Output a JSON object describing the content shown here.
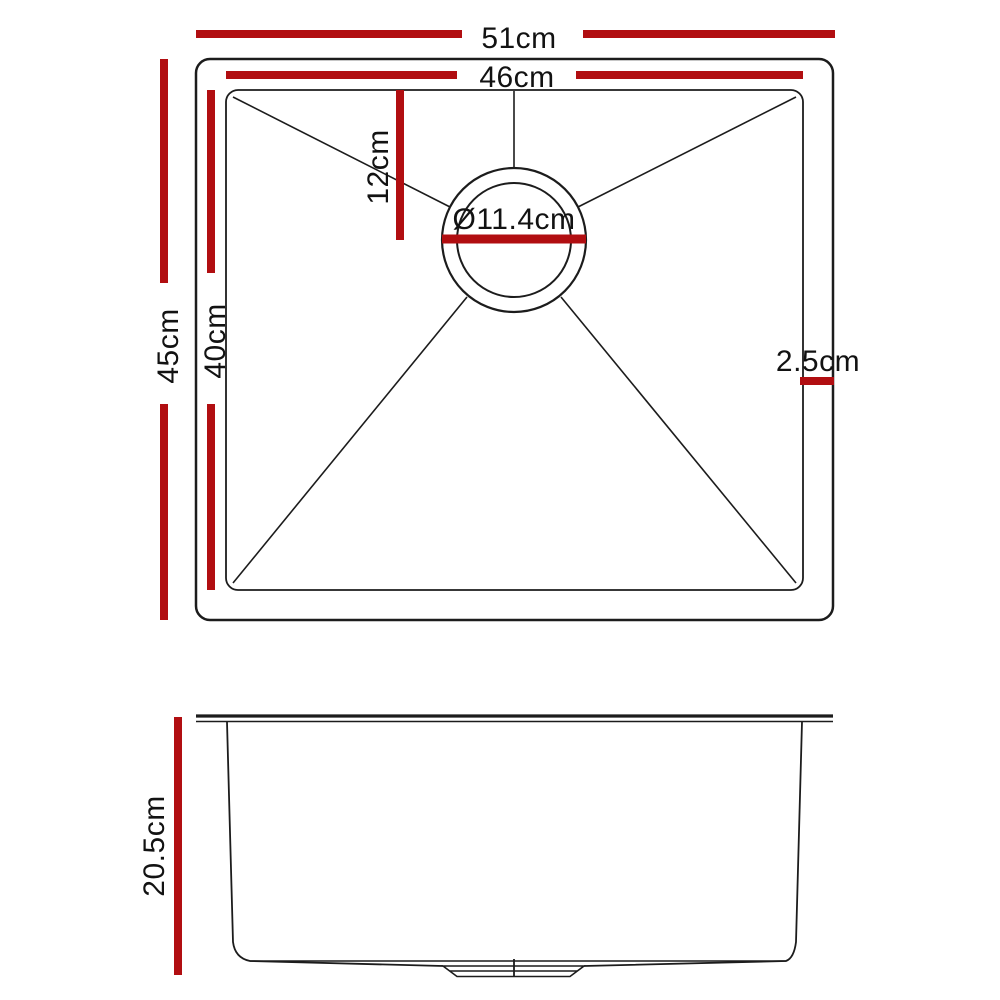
{
  "colors": {
    "dimension": "#b10e11",
    "outline": "#1c1c1c",
    "text": "#121212",
    "background": "#ffffff"
  },
  "labels": {
    "outer_width": "51cm",
    "inner_width": "46cm",
    "outer_depth": "45cm",
    "inner_depth": "40cm",
    "drain_offset": "12cm",
    "drain_diameter": "Ø11.4cm",
    "rim_width": "2.5cm",
    "bowl_height": "20.5cm"
  }
}
